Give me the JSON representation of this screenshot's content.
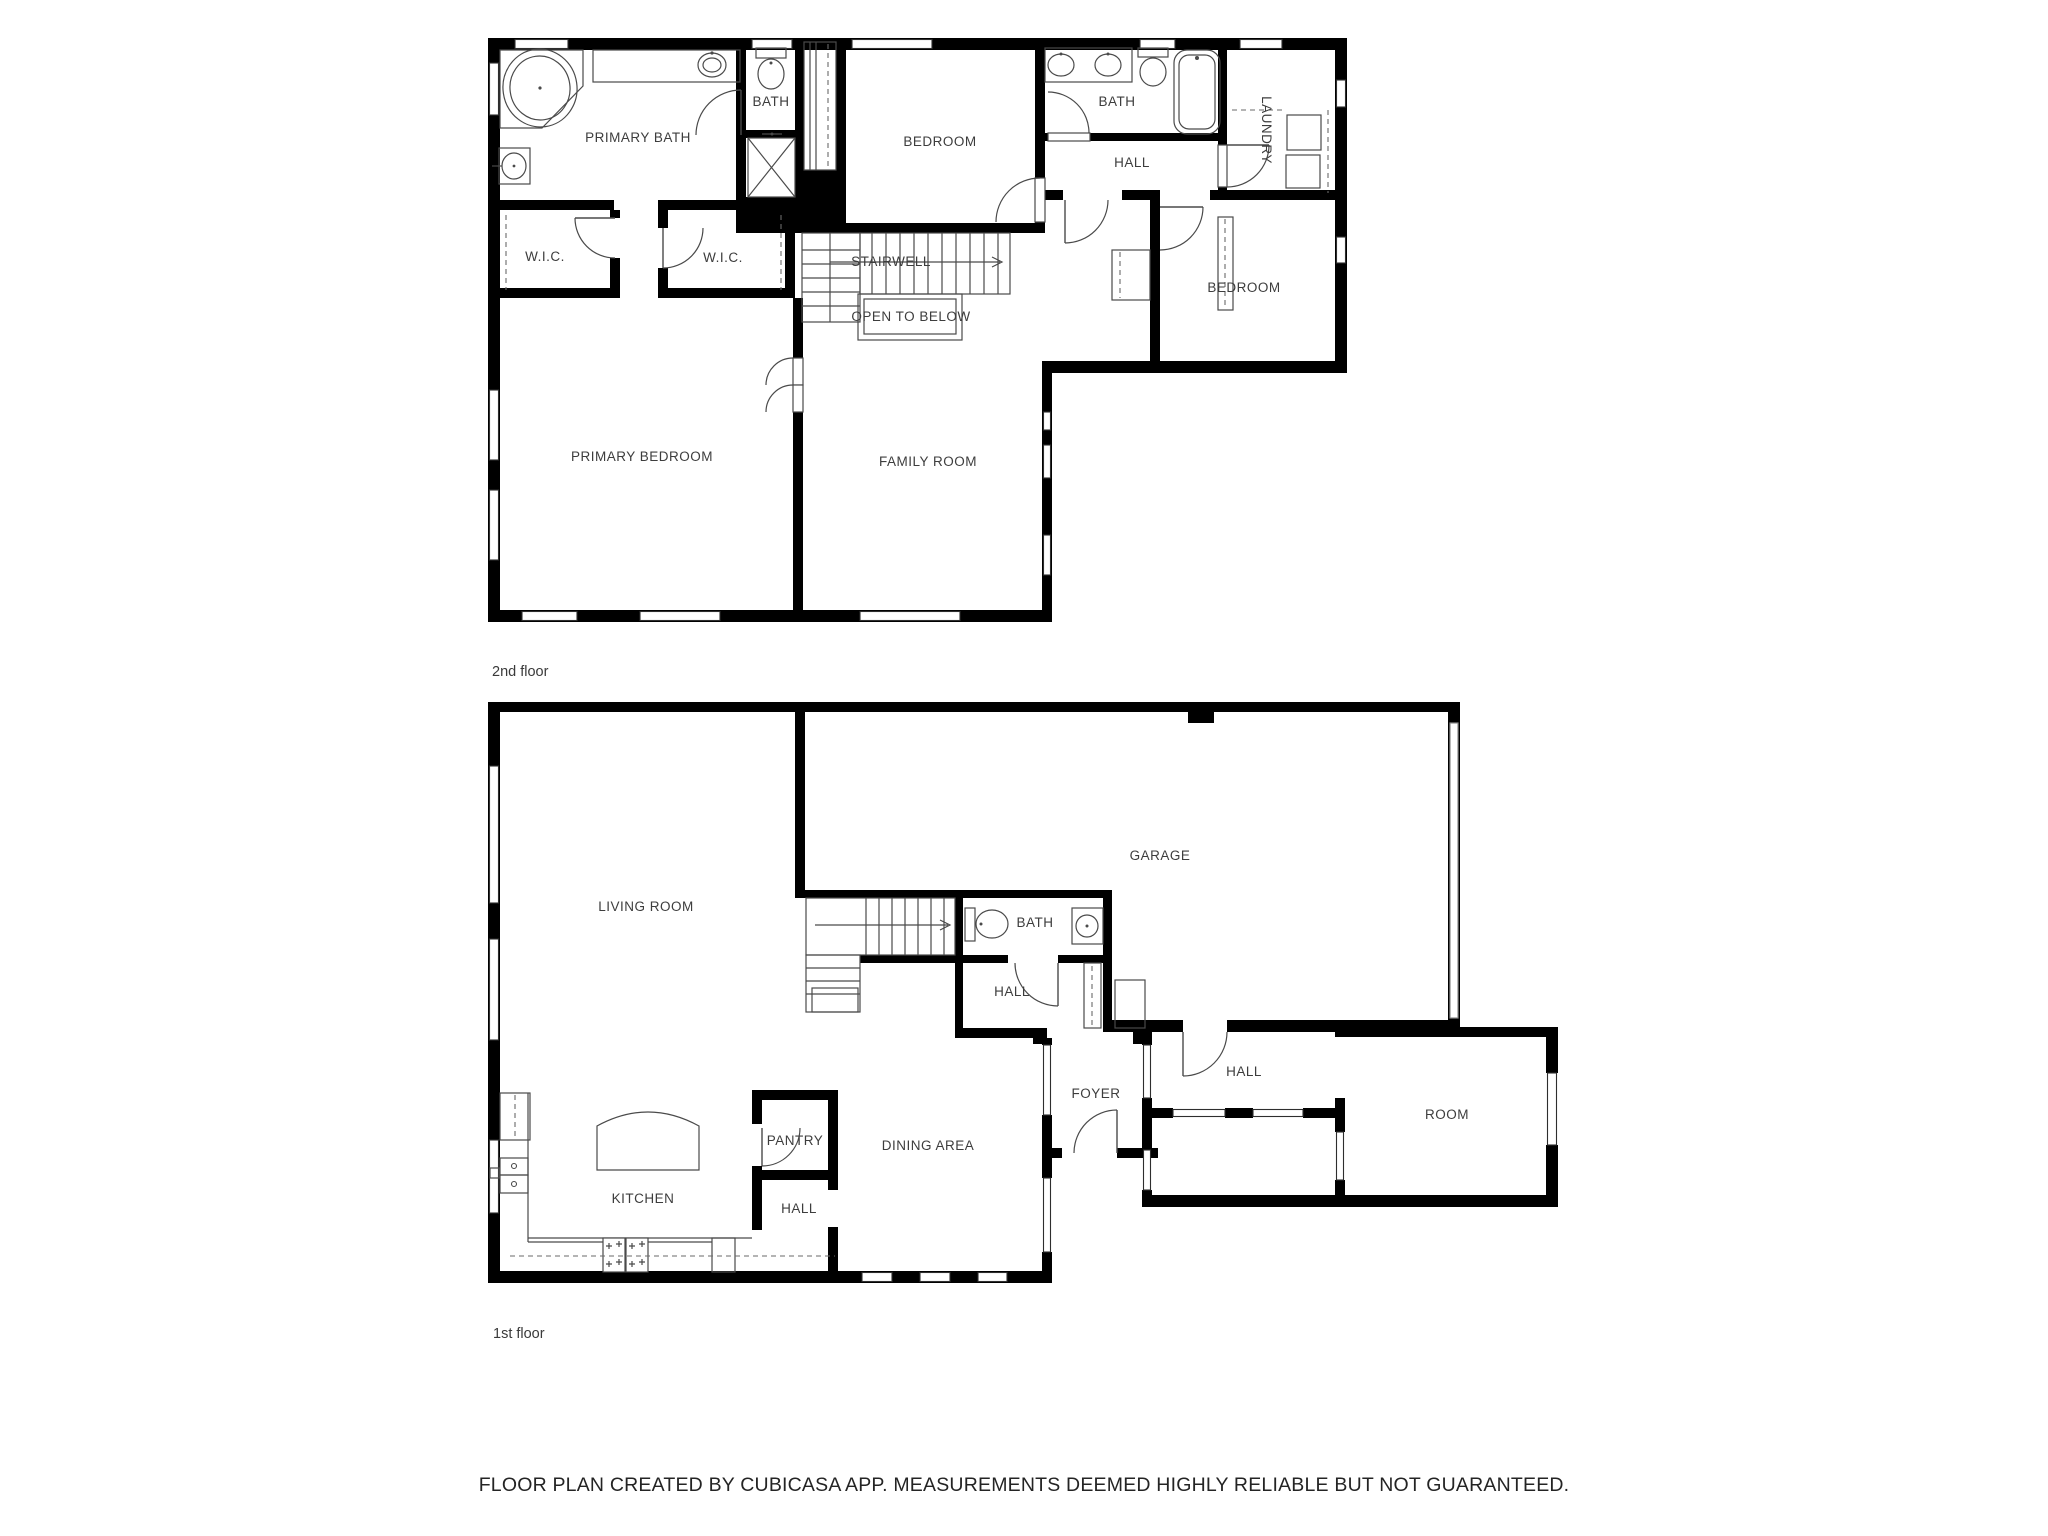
{
  "document": {
    "type": "floor-plan",
    "creator_note": "FLOOR PLAN CREATED BY CUBICASA APP. MEASUREMENTS DEEMED HIGHLY RELIABLE BUT NOT GUARANTEED."
  },
  "colors": {
    "wall": "#000000",
    "thin_line": "#4a4a4a",
    "label_text": "#3d3d3d",
    "background": "#ffffff"
  },
  "floors": [
    {
      "caption": "2nd floor",
      "rooms": {
        "primary_bath": "PRIMARY BATH",
        "bath_small": "BATH",
        "bedroom_middle": "BEDROOM",
        "bath_right": "BATH",
        "laundry": "LAUNDRY",
        "hall": "HALL",
        "wic_left": "W.I.C.",
        "wic_right": "W.I.C.",
        "stairwell": "STAIRWELL",
        "open_to_below": "OPEN TO BELOW",
        "bedroom_right": "BEDROOM",
        "primary_bedroom": "PRIMARY BEDROOM",
        "family_room": "FAMILY ROOM"
      }
    },
    {
      "caption": "1st floor",
      "rooms": {
        "living_room": "LIVING ROOM",
        "garage": "GARAGE",
        "bath": "BATH",
        "hall_center": "HALL",
        "foyer": "FOYER",
        "hall_right": "HALL",
        "room": "ROOM",
        "pantry": "PANTRY",
        "dining_area": "DINING AREA",
        "kitchen": "KITCHEN",
        "hall_kitchen": "HALL"
      }
    }
  ],
  "footer": {
    "disclaimer": "FLOOR PLAN CREATED BY CUBICASA APP. MEASUREMENTS DEEMED HIGHLY RELIABLE BUT NOT GUARANTEED."
  }
}
